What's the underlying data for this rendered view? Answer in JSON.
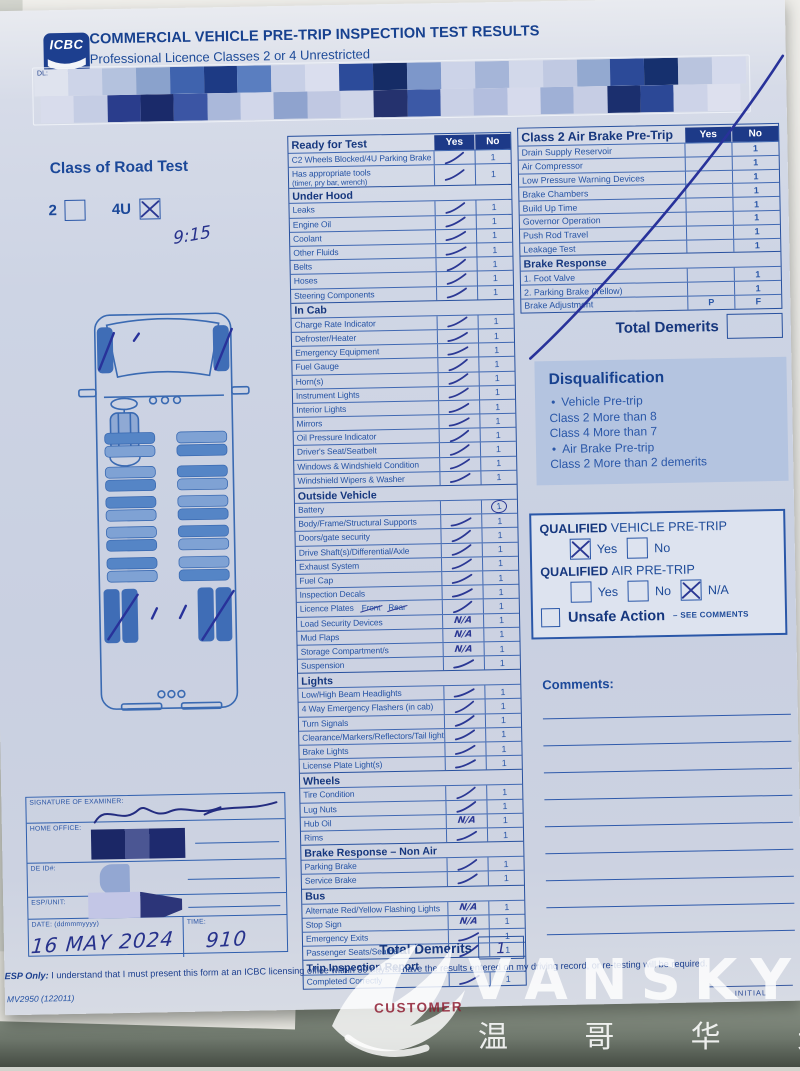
{
  "header": {
    "logo_text": "ICBC",
    "title": "COMMERCIAL VEHICLE PRE-TRIP INSPECTION TEST RESULTS",
    "subtitle": "Professional Licence Classes 2 or 4 Unrestricted",
    "dl_field_label": "DL:"
  },
  "class_of_road_test": {
    "title": "Class of Road Test",
    "options": [
      {
        "label": "2",
        "checked": false
      },
      {
        "label": "4U",
        "checked": true
      }
    ],
    "handwritten_note": "9:15"
  },
  "checklist": {
    "col_yes": "Yes",
    "col_no": "No",
    "sections": [
      {
        "title": "Ready for Test",
        "rows": [
          {
            "label": "C2 Wheels Blocked/4U Parking Brake",
            "mark": "check",
            "demerit": "1"
          },
          {
            "label": "Has appropriate tools",
            "sub": "(timer, pry bar, wrench)",
            "mark": "check",
            "demerit": "1"
          }
        ]
      },
      {
        "title": "Under Hood",
        "rows": [
          {
            "label": "Leaks",
            "mark": "check",
            "demerit": "1"
          },
          {
            "label": "Engine Oil",
            "mark": "check",
            "demerit": "1"
          },
          {
            "label": "Coolant",
            "mark": "check",
            "demerit": "1"
          },
          {
            "label": "Other Fluids",
            "mark": "check",
            "demerit": "1"
          },
          {
            "label": "Belts",
            "mark": "check",
            "demerit": "1"
          },
          {
            "label": "Hoses",
            "mark": "check",
            "demerit": "1"
          },
          {
            "label": "Steering Components",
            "mark": "check",
            "demerit": "1"
          }
        ]
      },
      {
        "title": "In Cab",
        "rows": [
          {
            "label": "Charge Rate Indicator",
            "mark": "check",
            "demerit": "1"
          },
          {
            "label": "Defroster/Heater",
            "mark": "check",
            "demerit": "1"
          },
          {
            "label": "Emergency Equipment",
            "mark": "check",
            "demerit": "1"
          },
          {
            "label": "Fuel Gauge",
            "mark": "check",
            "demerit": "1"
          },
          {
            "label": "Horn(s)",
            "mark": "check",
            "demerit": "1"
          },
          {
            "label": "Instrument Lights",
            "mark": "check",
            "demerit": "1"
          },
          {
            "label": "Interior Lights",
            "mark": "check",
            "demerit": "1"
          },
          {
            "label": "Mirrors",
            "mark": "check",
            "demerit": "1"
          },
          {
            "label": "Oil Pressure Indicator",
            "mark": "check",
            "demerit": "1"
          },
          {
            "label": "Driver's Seat/Seatbelt",
            "mark": "check",
            "demerit": "1"
          },
          {
            "label": "Windows & Windshield Condition",
            "mark": "check",
            "demerit": "1"
          },
          {
            "label": "Windshield Wipers & Washer",
            "mark": "check",
            "demerit": "1"
          }
        ]
      },
      {
        "title": "Outside Vehicle",
        "rows": [
          {
            "label": "Battery",
            "mark": "none",
            "demerit": "1",
            "circled": true
          },
          {
            "label": "Body/Frame/Structural Supports",
            "mark": "check",
            "demerit": "1"
          },
          {
            "label": "Doors/gate security",
            "mark": "check",
            "demerit": "1"
          },
          {
            "label": "Drive Shaft(s)/Differential/Axle",
            "mark": "check",
            "demerit": "1"
          },
          {
            "label": "Exhaust System",
            "mark": "check",
            "demerit": "1"
          },
          {
            "label": "Fuel Cap",
            "mark": "check",
            "demerit": "1"
          },
          {
            "label": "Inspection Decals",
            "mark": "check",
            "demerit": "1"
          },
          {
            "label": "Licence Plates",
            "extras": [
              "Front",
              "Rear"
            ],
            "mark": "check",
            "demerit": "1"
          },
          {
            "label": "Load Security Devices",
            "mark": "na",
            "demerit": "1"
          },
          {
            "label": "Mud Flaps",
            "mark": "na",
            "demerit": "1"
          },
          {
            "label": "Storage Compartment/s",
            "mark": "na",
            "demerit": "1"
          },
          {
            "label": "Suspension",
            "mark": "check",
            "demerit": "1"
          }
        ]
      },
      {
        "title": "Lights",
        "rows": [
          {
            "label": "Low/High Beam Headlights",
            "mark": "check",
            "demerit": "1"
          },
          {
            "label": "4 Way Emergency Flashers (in cab)",
            "mark": "check",
            "demerit": "1"
          },
          {
            "label": "Turn Signals",
            "mark": "check",
            "demerit": "1"
          },
          {
            "label": "Clearance/Markers/Reflectors/Tail lights",
            "mark": "check",
            "demerit": "1"
          },
          {
            "label": "Brake Lights",
            "mark": "check",
            "demerit": "1"
          },
          {
            "label": "License Plate Light(s)",
            "mark": "check",
            "demerit": "1"
          }
        ]
      },
      {
        "title": "Wheels",
        "rows": [
          {
            "label": "Tire Condition",
            "mark": "check",
            "demerit": "1"
          },
          {
            "label": "Lug Nuts",
            "mark": "check",
            "demerit": "1"
          },
          {
            "label": "Hub Oil",
            "mark": "na",
            "demerit": "1"
          },
          {
            "label": "Rims",
            "mark": "check",
            "demerit": "1"
          }
        ]
      },
      {
        "title": "Brake Response – Non Air",
        "rows": [
          {
            "label": "Parking Brake",
            "mark": "check",
            "demerit": "1"
          },
          {
            "label": "Service Brake",
            "mark": "check",
            "demerit": "1"
          }
        ]
      },
      {
        "title": "Bus",
        "rows": [
          {
            "label": "Alternate Red/Yellow Flashing Lights",
            "mark": "na",
            "demerit": "1"
          },
          {
            "label": "Stop Sign",
            "mark": "na",
            "demerit": "1"
          },
          {
            "label": "Emergency Exits",
            "mark": "check",
            "demerit": "1"
          },
          {
            "label": "Passenger Seats/Seatbelts",
            "mark": "check",
            "demerit": "1"
          }
        ]
      },
      {
        "title": "Trip Inspection Report",
        "rows": [
          {
            "label": "Completed Correctly",
            "mark": "check",
            "demerit": "1"
          }
        ]
      }
    ],
    "total_label": "Total Demerits",
    "total_value": "1"
  },
  "air_brake": {
    "title": "Class 2 Air Brake Pre-Trip",
    "col_yes": "Yes",
    "col_no": "No",
    "rows": [
      {
        "label": "Drain Supply Reservoir",
        "yes": "",
        "no": "1"
      },
      {
        "label": "Air Compressor",
        "yes": "",
        "no": "1"
      },
      {
        "label": "Low Pressure Warning Devices",
        "yes": "",
        "no": "1"
      },
      {
        "label": "Brake Chambers",
        "yes": "",
        "no": "1"
      },
      {
        "label": "Build Up Time",
        "yes": "",
        "no": "1"
      },
      {
        "label": "Governor Operation",
        "yes": "",
        "no": "1"
      },
      {
        "label": "Push Rod Travel",
        "yes": "",
        "no": "1"
      },
      {
        "label": "Leakage Test",
        "yes": "",
        "no": "1"
      }
    ],
    "subsection_title": "Brake Response",
    "sub_rows": [
      {
        "label": "1. Foot Valve",
        "yes": "",
        "no": "1"
      },
      {
        "label": "2. Parking Brake (Yellow)",
        "yes": "",
        "no": "1"
      },
      {
        "label": "Brake Adjustment",
        "yes": "P",
        "no": "F"
      }
    ],
    "total_label": "Total Demerits",
    "total_value": "",
    "crossed_out": true
  },
  "disqualification": {
    "title": "Disqualification",
    "items": [
      {
        "bullet": true,
        "text": "Vehicle Pre-trip"
      },
      {
        "bullet": false,
        "text": "Class 2 More than 8"
      },
      {
        "bullet": false,
        "text": "Class 4 More than 7"
      },
      {
        "bullet": true,
        "text": "Air Brake Pre-trip"
      },
      {
        "bullet": false,
        "text": "Class 2 More than 2 demerits"
      }
    ]
  },
  "qualified": {
    "groups": [
      {
        "bold": "QUALIFIED",
        "rest": "VEHICLE PRE-TRIP",
        "options": [
          {
            "label": "Yes",
            "checked": true
          },
          {
            "label": "No",
            "checked": false
          }
        ]
      },
      {
        "bold": "QUALIFIED",
        "rest": "AIR PRE-TRIP",
        "options": [
          {
            "label": "Yes",
            "checked": false
          },
          {
            "label": "No",
            "checked": false
          },
          {
            "label": "N/A",
            "checked": true
          }
        ]
      }
    ],
    "unsafe_label": "Unsafe Action",
    "unsafe_suffix": "– SEE COMMENTS",
    "unsafe_checked": false
  },
  "comments": {
    "label": "Comments:",
    "line_count": 9
  },
  "examiner": {
    "signature_label": "SIGNATURE OF EXAMINER:",
    "home_office_label": "HOME OFFICE:",
    "de_id_label": "DE ID#:",
    "esp_unit_label": "ESP/UNIT:",
    "date_label": "DATE: (ddmmmyyyy)",
    "date_value": "16 MAY 2024",
    "time_label": "TIME:",
    "time_value": "910"
  },
  "footer": {
    "esp_bold": "ESP Only:",
    "esp_text": "I understand that I must present this form at an ICBC licensing office within 30 days to have the results entered on my driving record, or re-testing will be required.",
    "form_number": "MV2950 (122011)",
    "customer_label": "CUSTOMER",
    "initial_label": "INITIAL"
  },
  "watermark": {
    "brand": "VANSKY",
    "cjk": "温 哥 华 天 空"
  },
  "redaction_rows": [
    [
      "#dfe3ee",
      "#cdd4e8",
      "#b4c2de",
      "#8aa2cc",
      "#3f63ae",
      "#1d3a84",
      "#5a7ec0",
      "#c7cfe6",
      "#dadeee",
      "#2c4b9a",
      "#152c66",
      "#7d97ca",
      "#ccd3e8",
      "#a5b5d8",
      "#d2d8ea",
      "#c0c9e2",
      "#93a9d0",
      "#2c4a98",
      "#16306e",
      "#b9c4de",
      "#d5daec"
    ],
    [
      "#d8dcec",
      "#c5cde4",
      "#2a3d8c",
      "#1a2a6a",
      "#3b55a4",
      "#aab8da",
      "#d2d7ea",
      "#8fa3ce",
      "#c0c8e2",
      "#cfd5e8",
      "#25326e",
      "#3c59a6",
      "#c9d0e6",
      "#b3bede",
      "#d6daec",
      "#9fb0d6",
      "#c6cde4",
      "#1b2f6e",
      "#2c4896",
      "#cdd3e8",
      "#dde0ee"
    ]
  ],
  "colors": {
    "form_blue": "#2452a4",
    "header_navy": "#1d3a88",
    "ink": "#2b3894",
    "paper": "#cdd4e4",
    "disq_panel": "#b4c4e0",
    "customer_red": "#8e1d31"
  }
}
